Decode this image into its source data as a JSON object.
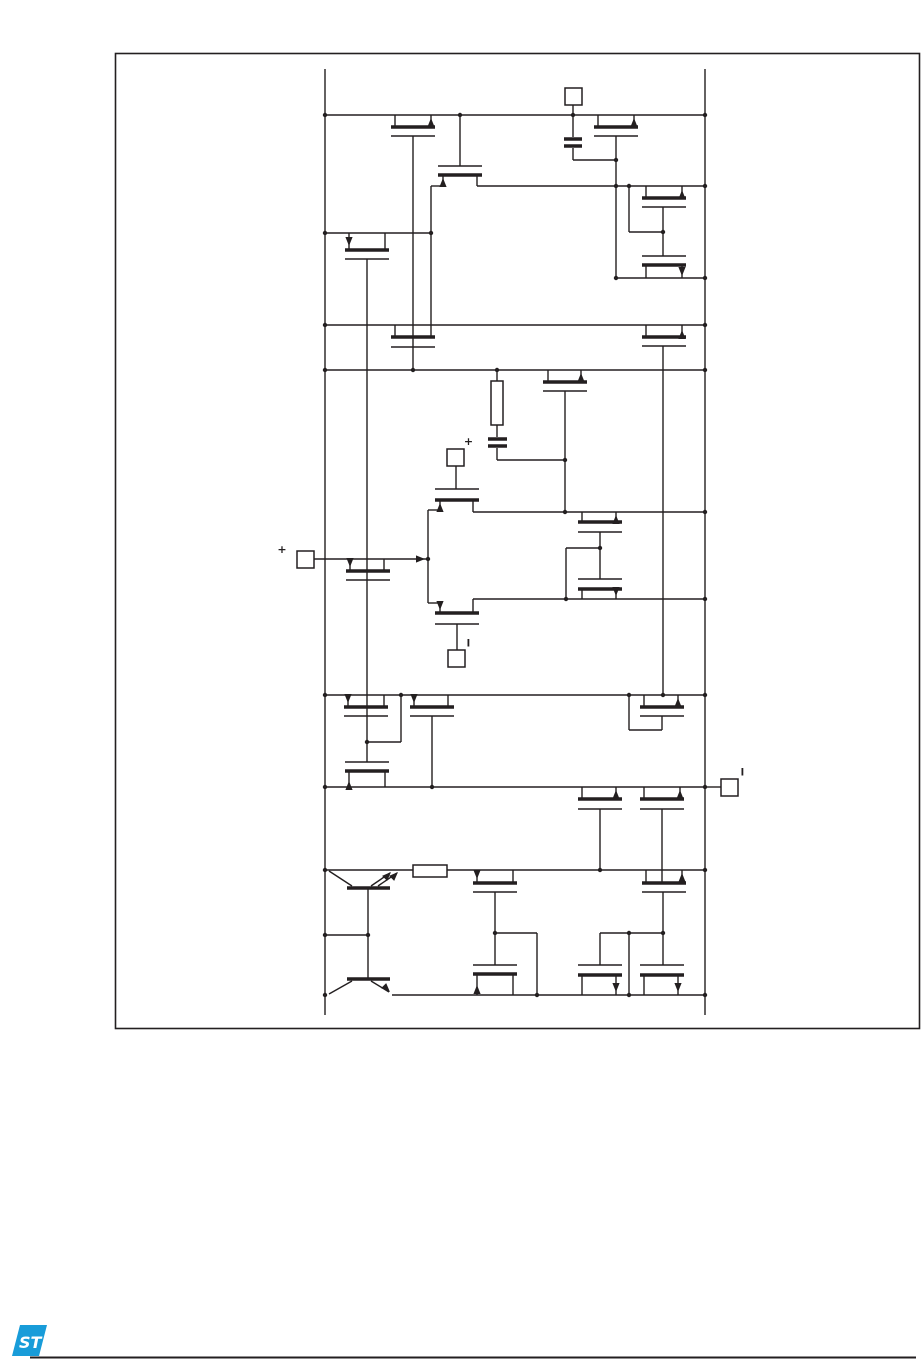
{
  "page": {
    "width": 922,
    "height": 1361,
    "background": "#ffffff"
  },
  "schematic": {
    "description": "Operational amplifier internal transistor-level schematic",
    "line_color": "#231f20",
    "border_color": "#231f20",
    "labels": {
      "center_input_plus": "+",
      "left_input_plus": "+"
    },
    "terminals": [
      {
        "name": "top-terminal",
        "label": ""
      },
      {
        "name": "center-input-terminal",
        "label": "+"
      },
      {
        "name": "left-input-terminal",
        "label": "+"
      },
      {
        "name": "lower-input-terminal",
        "label": "|"
      },
      {
        "name": "output-terminal",
        "label": "|"
      }
    ],
    "component_counts": {
      "mosfets": 25,
      "bipolar_transistors": 2,
      "capacitors": 2,
      "resistors": 2,
      "terminal_pads": 5
    }
  },
  "footer": {
    "logo_text": "ST",
    "logo_color": "#189cd9",
    "rule_color": "#231f20"
  }
}
